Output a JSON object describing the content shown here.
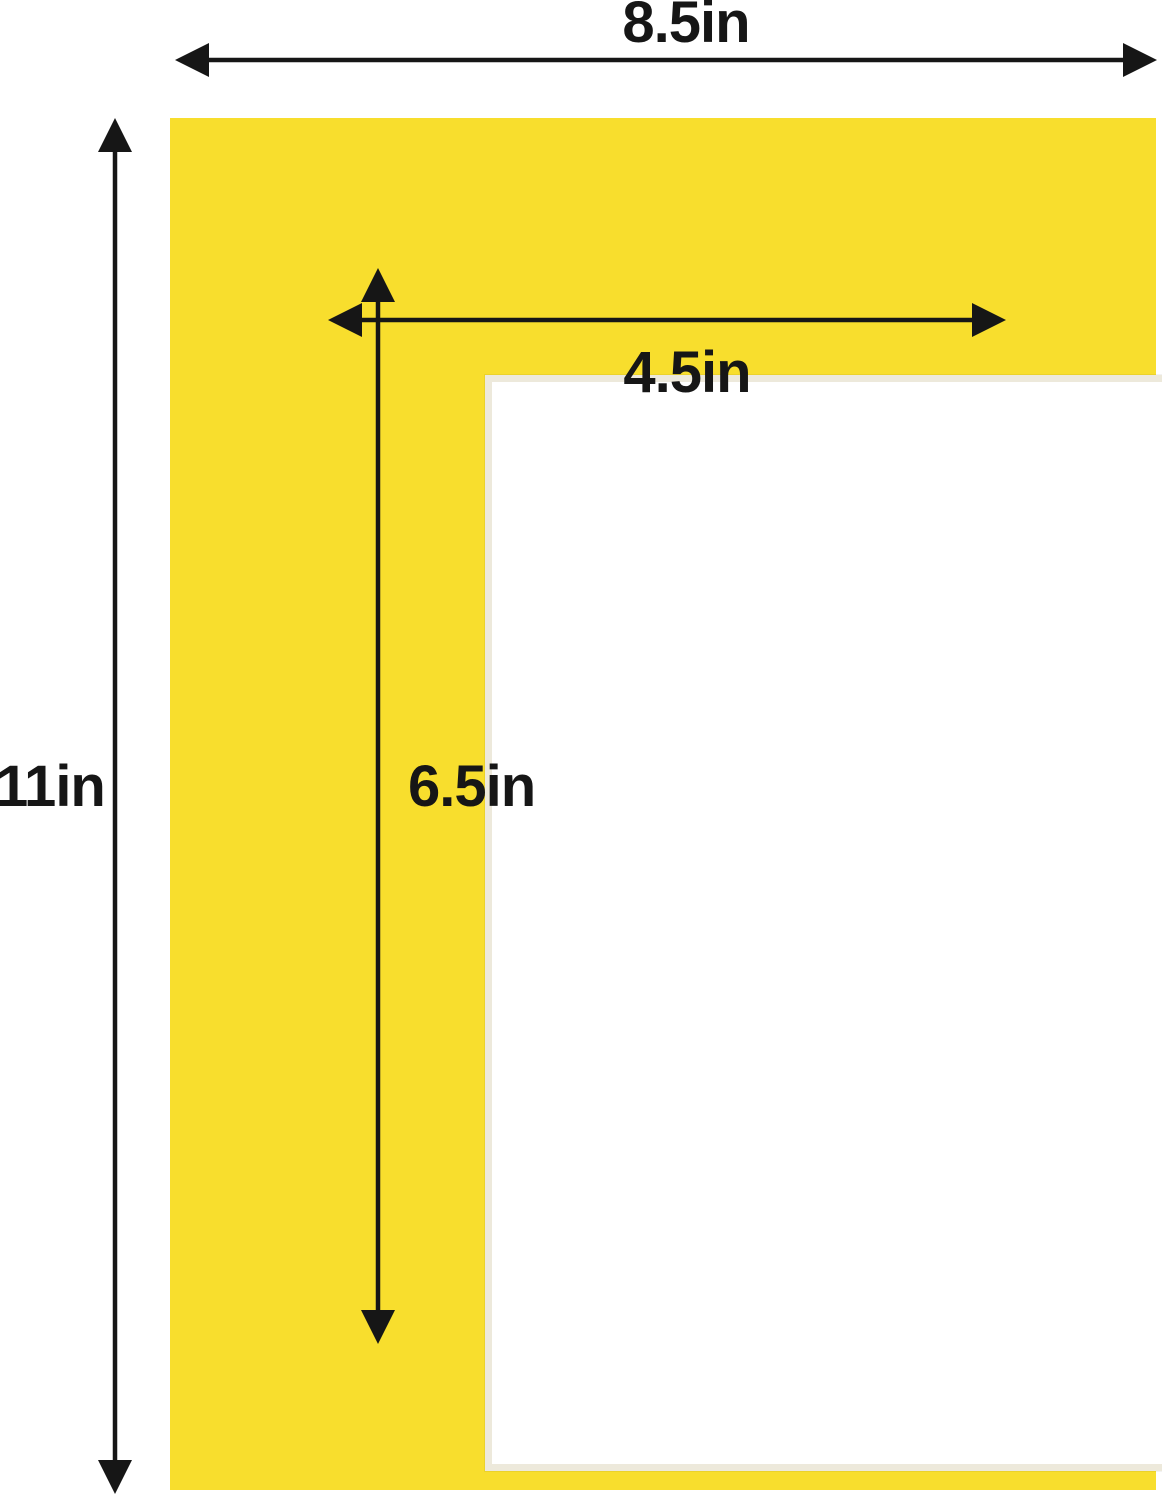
{
  "diagram": {
    "description": "Yellow picture frame mat board dimension diagram",
    "labels": {
      "outer_width": "8.5in",
      "outer_height": "11in",
      "opening_width": "4.5in",
      "opening_height": "6.5in"
    }
  },
  "colors": {
    "mat_yellow": "#F8DE2D",
    "bevel_cream": "#EDE9DB",
    "arrow_black": "#161616",
    "text": "#161616",
    "background": "#FFFFFF"
  }
}
